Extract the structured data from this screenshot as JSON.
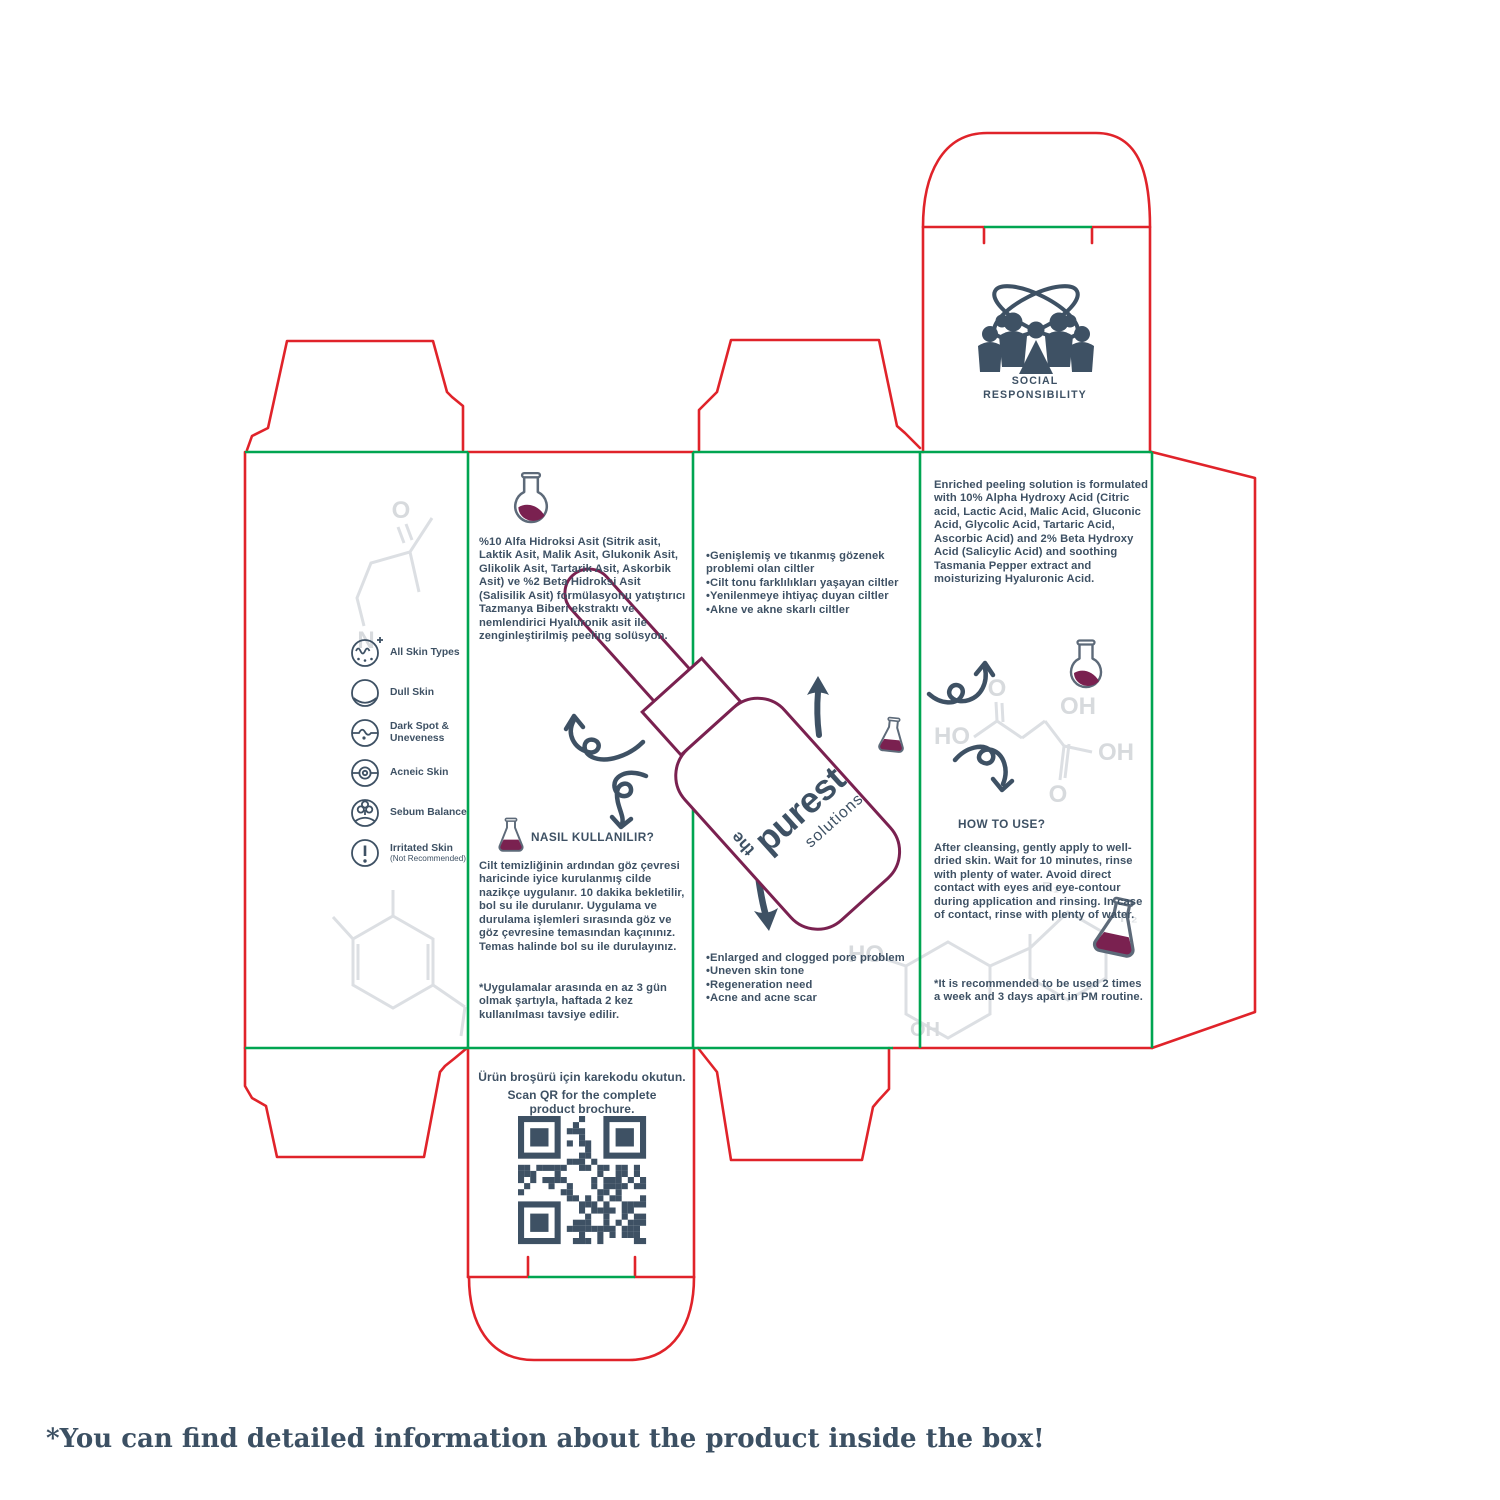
{
  "page": {
    "caption": "*You can find detailed information about the product inside the box!",
    "background": "#ffffff"
  },
  "colors": {
    "cut_line": "#e0232a",
    "fold_line": "#00a551",
    "ink": "#3e5164",
    "maroon": "#7a2150",
    "watermark": "#d9dcdf"
  },
  "icons": {
    "flask_round": "round-bottom-flask",
    "flask_erlenmeyer": "erlenmeyer-flask",
    "social": "people-with-atom-orbits",
    "qr": "qr-code",
    "arrows": "hand-drawn-sketch-arrows",
    "bottle": "dropper-bottle"
  },
  "top_flap": {
    "line1": "SOCIAL",
    "line2": "RESPONSIBILITY"
  },
  "left_panel": {
    "skin_types": [
      {
        "label": "All Skin Types"
      },
      {
        "label": "Dull Skin"
      },
      {
        "label": "Dark Spot & Uneveness"
      },
      {
        "label": "Acneic Skin"
      },
      {
        "label": "Sebum Balance"
      },
      {
        "label": "Irritated Skin",
        "note": "(Not Recommended)"
      }
    ]
  },
  "panel_tr": {
    "description": "%10 Alfa Hidroksi Asit (Sitrik asit, Laktik Asit, Malik Asit, Glukonik Asit, Glikolik Asit, Tartarik Asit, Askorbik Asit) ve %2 Beta Hidroksi Asit (Salisilik Asit) formülasyonu yatıştırıcı Tazmanya Biberi ekstraktı ve nemlendirici Hyaluronik asit ile zenginleştirilmiş peeling solüsyon.",
    "how_to_title": "NASIL KULLANILIR?",
    "how_to": "Cilt temizliğinin ardından göz çevresi haricinde iyice kurulanmış cilde nazikçe uygulanır. 10 dakika bekletilir, bol su ile durulanır. Uygulama ve durulama işlemleri sırasında göz ve göz çevresine temasından kaçınınız. Temas halinde bol su ile durulayınız.",
    "note": "*Uygulamalar arasında en az 3 gün olmak şartıyla, haftada 2 kez kullanılması tavsiye edilir."
  },
  "panel_front": {
    "bullets_tr": "•Genişlemiş ve tıkanmış gözenek problemi olan ciltler\n•Cilt tonu farklılıkları yaşayan ciltler\n•Yenilenmeye ihtiyaç duyan ciltler\n•Akne ve akne skarlı ciltler",
    "bullets_en": "•Enlarged and clogged pore problem\n•Uneven skin tone\n•Regeneration need\n•Acne and acne scar",
    "logo": {
      "the": "the",
      "brand": "purest",
      "sub": "solutions"
    }
  },
  "panel_en": {
    "description": "Enriched peeling solution is formulated with 10% Alpha Hydroxy Acid (Citric acid, Lactic Acid, Malic Acid, Gluconic Acid, Glycolic Acid, Tartaric Acid, Ascorbic Acid) and 2% Beta Hydroxy Acid (Salicylic Acid) and soothing Tasmania Pepper extract and moisturizing Hyaluronic Acid.",
    "how_to_title": "HOW TO USE?",
    "how_to": "After cleansing, gently apply to well-dried skin. Wait for 10 minutes, rinse with plenty of water. Avoid direct contact with eyes and eye-contour during application and rinsing. In case of contact, rinse with plenty of water.",
    "note": "*It is recommended to be used 2 times a week and 3 days apart in PM routine."
  },
  "qr_panel": {
    "line_tr": "Ürün broşürü için karekodu okutun.",
    "line_en": "Scan QR for the complete\nproduct brochure."
  },
  "watermark_labels": {
    "o1": "O",
    "n1": "N",
    "ho1": "HO",
    "o2": "O",
    "oh1": "OH",
    "oh2": "OH",
    "o3": "O",
    "ho2": "HO",
    "oh3": "OH",
    "r1": "R₁",
    "r2": "R₂"
  }
}
